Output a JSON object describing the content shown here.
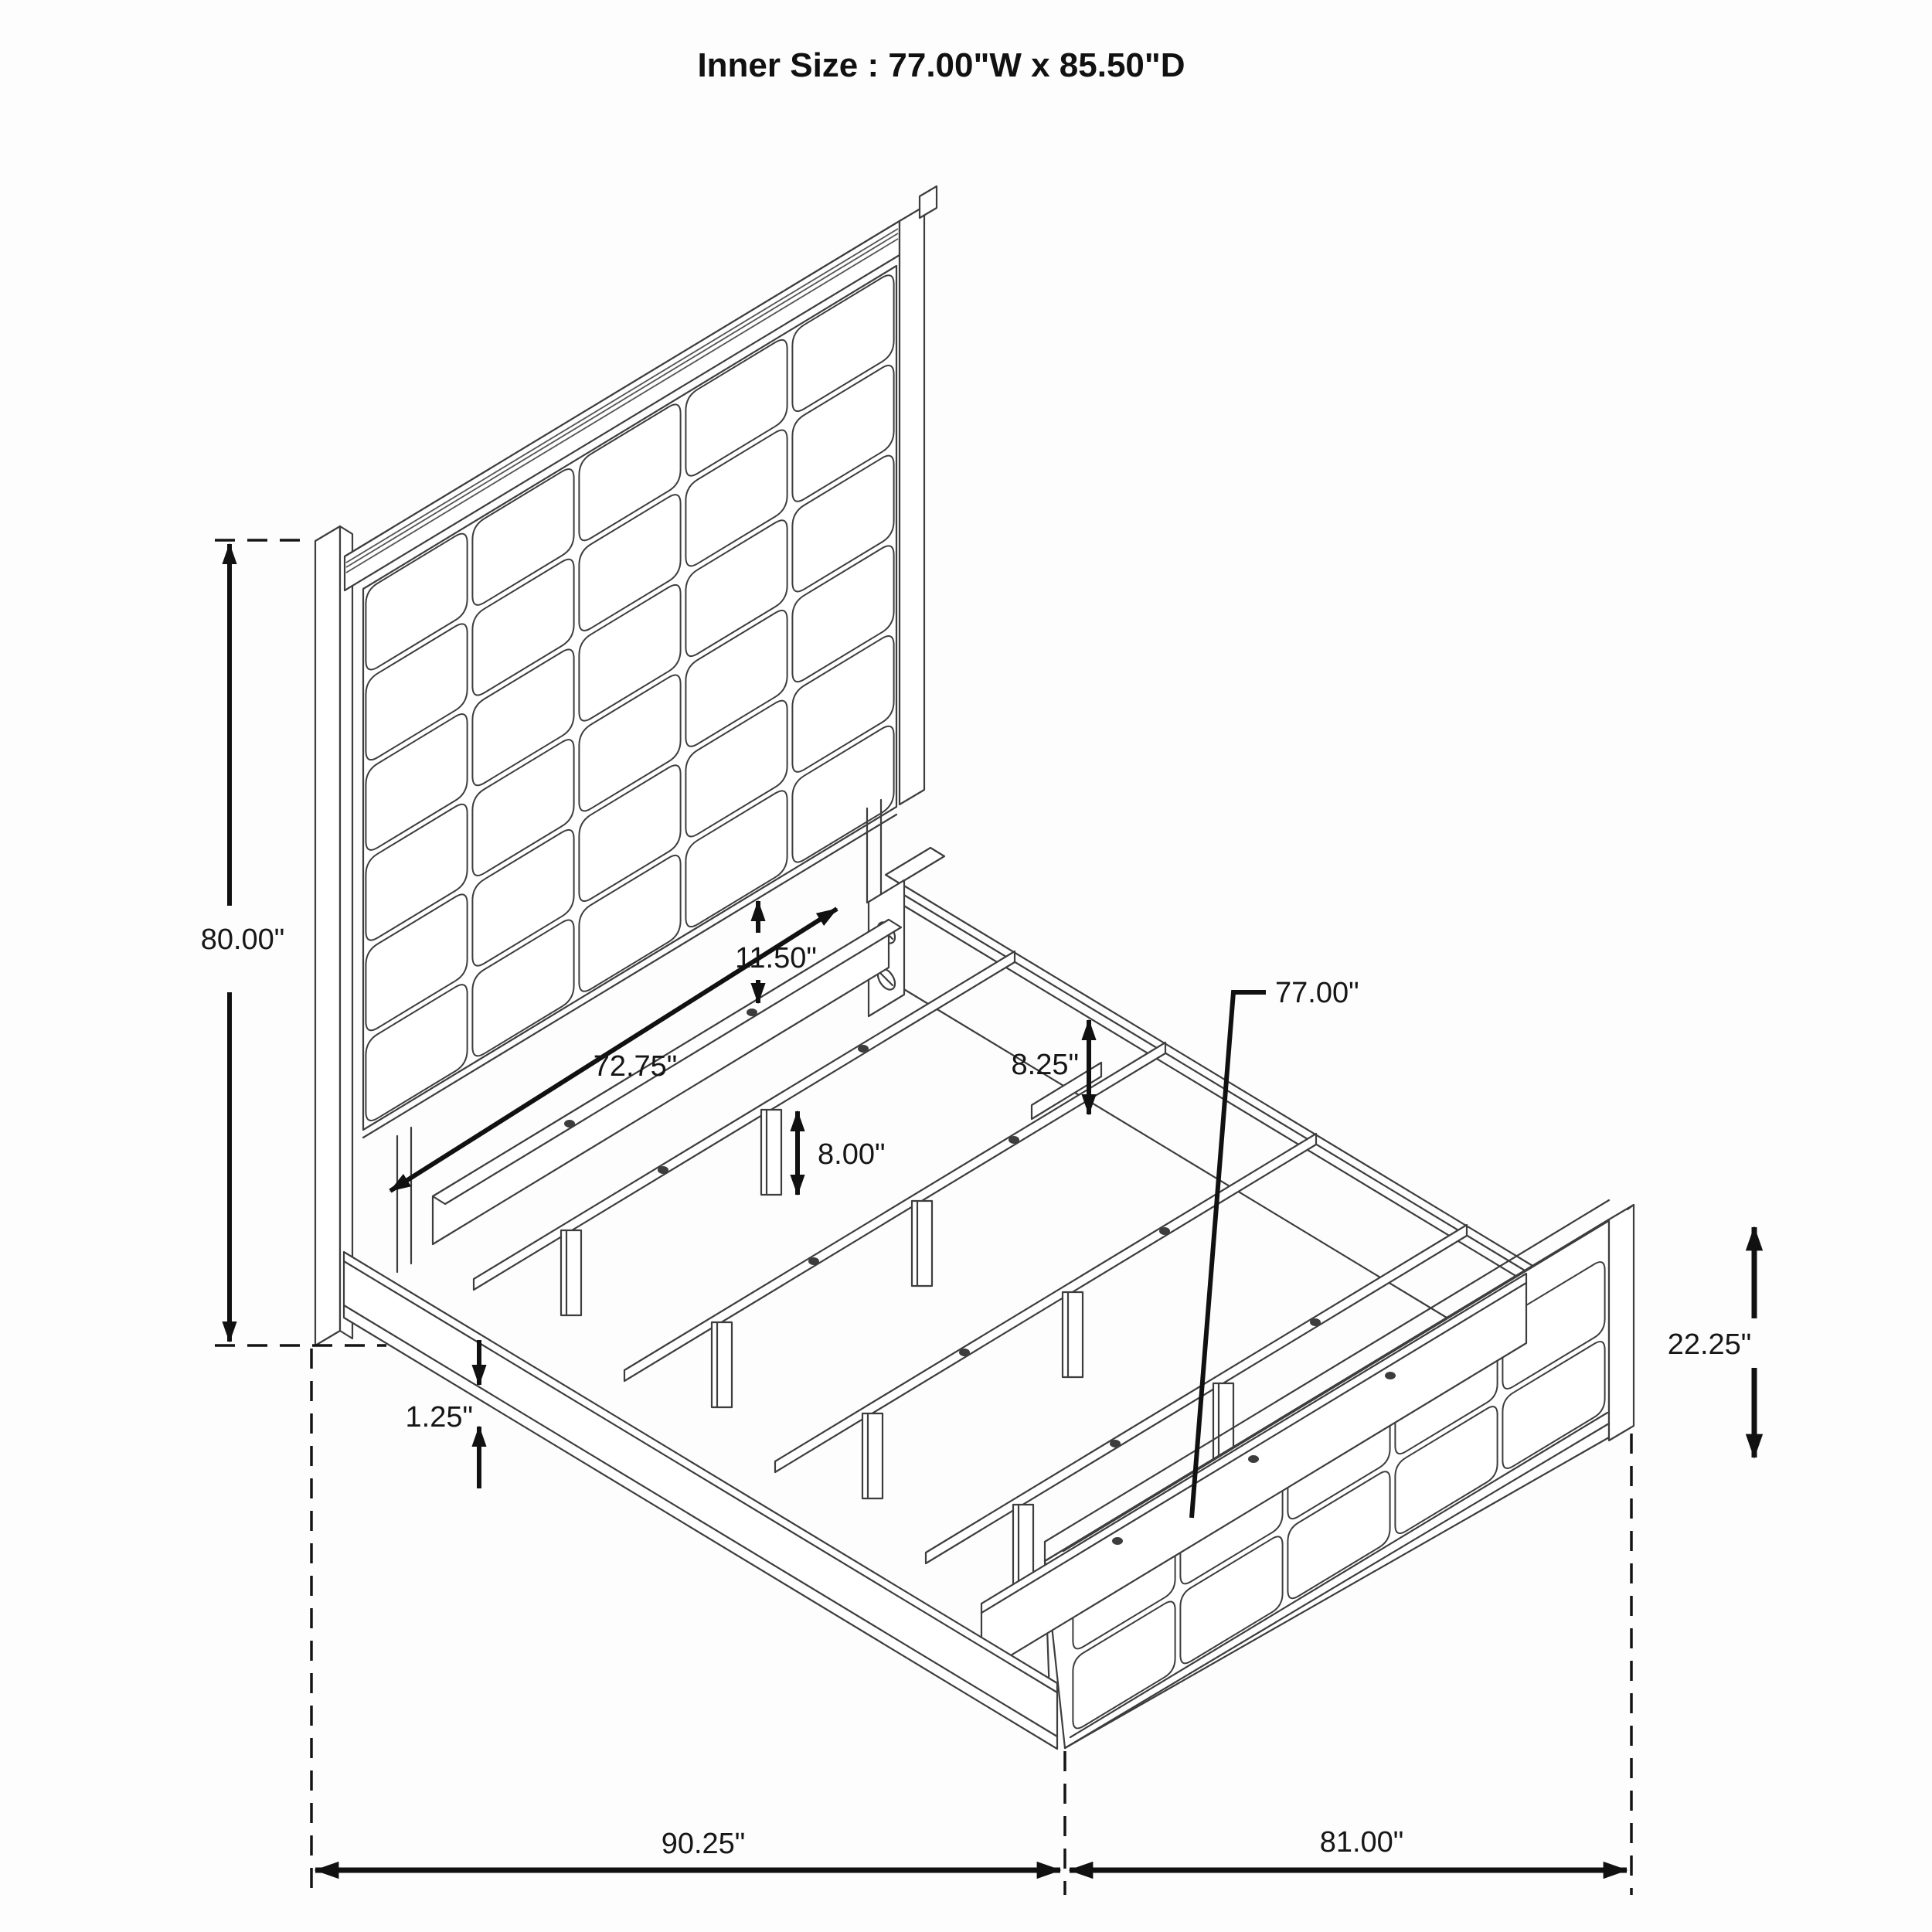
{
  "title": "Inner Size : 77.00\"W x 85.50\"D",
  "dims": {
    "headboard_height": "80.00\"",
    "panel_to_rail_gap": "11.50\"",
    "headboard_inner_width": "72.75\"",
    "side_rail_height": "8.25\"",
    "slat_length": "77.00\"",
    "support_leg_height": "8.00\"",
    "base_trim_height": "1.25\"",
    "footboard_height": "22.25\"",
    "overall_length": "90.25\"",
    "overall_width": "81.00\""
  }
}
